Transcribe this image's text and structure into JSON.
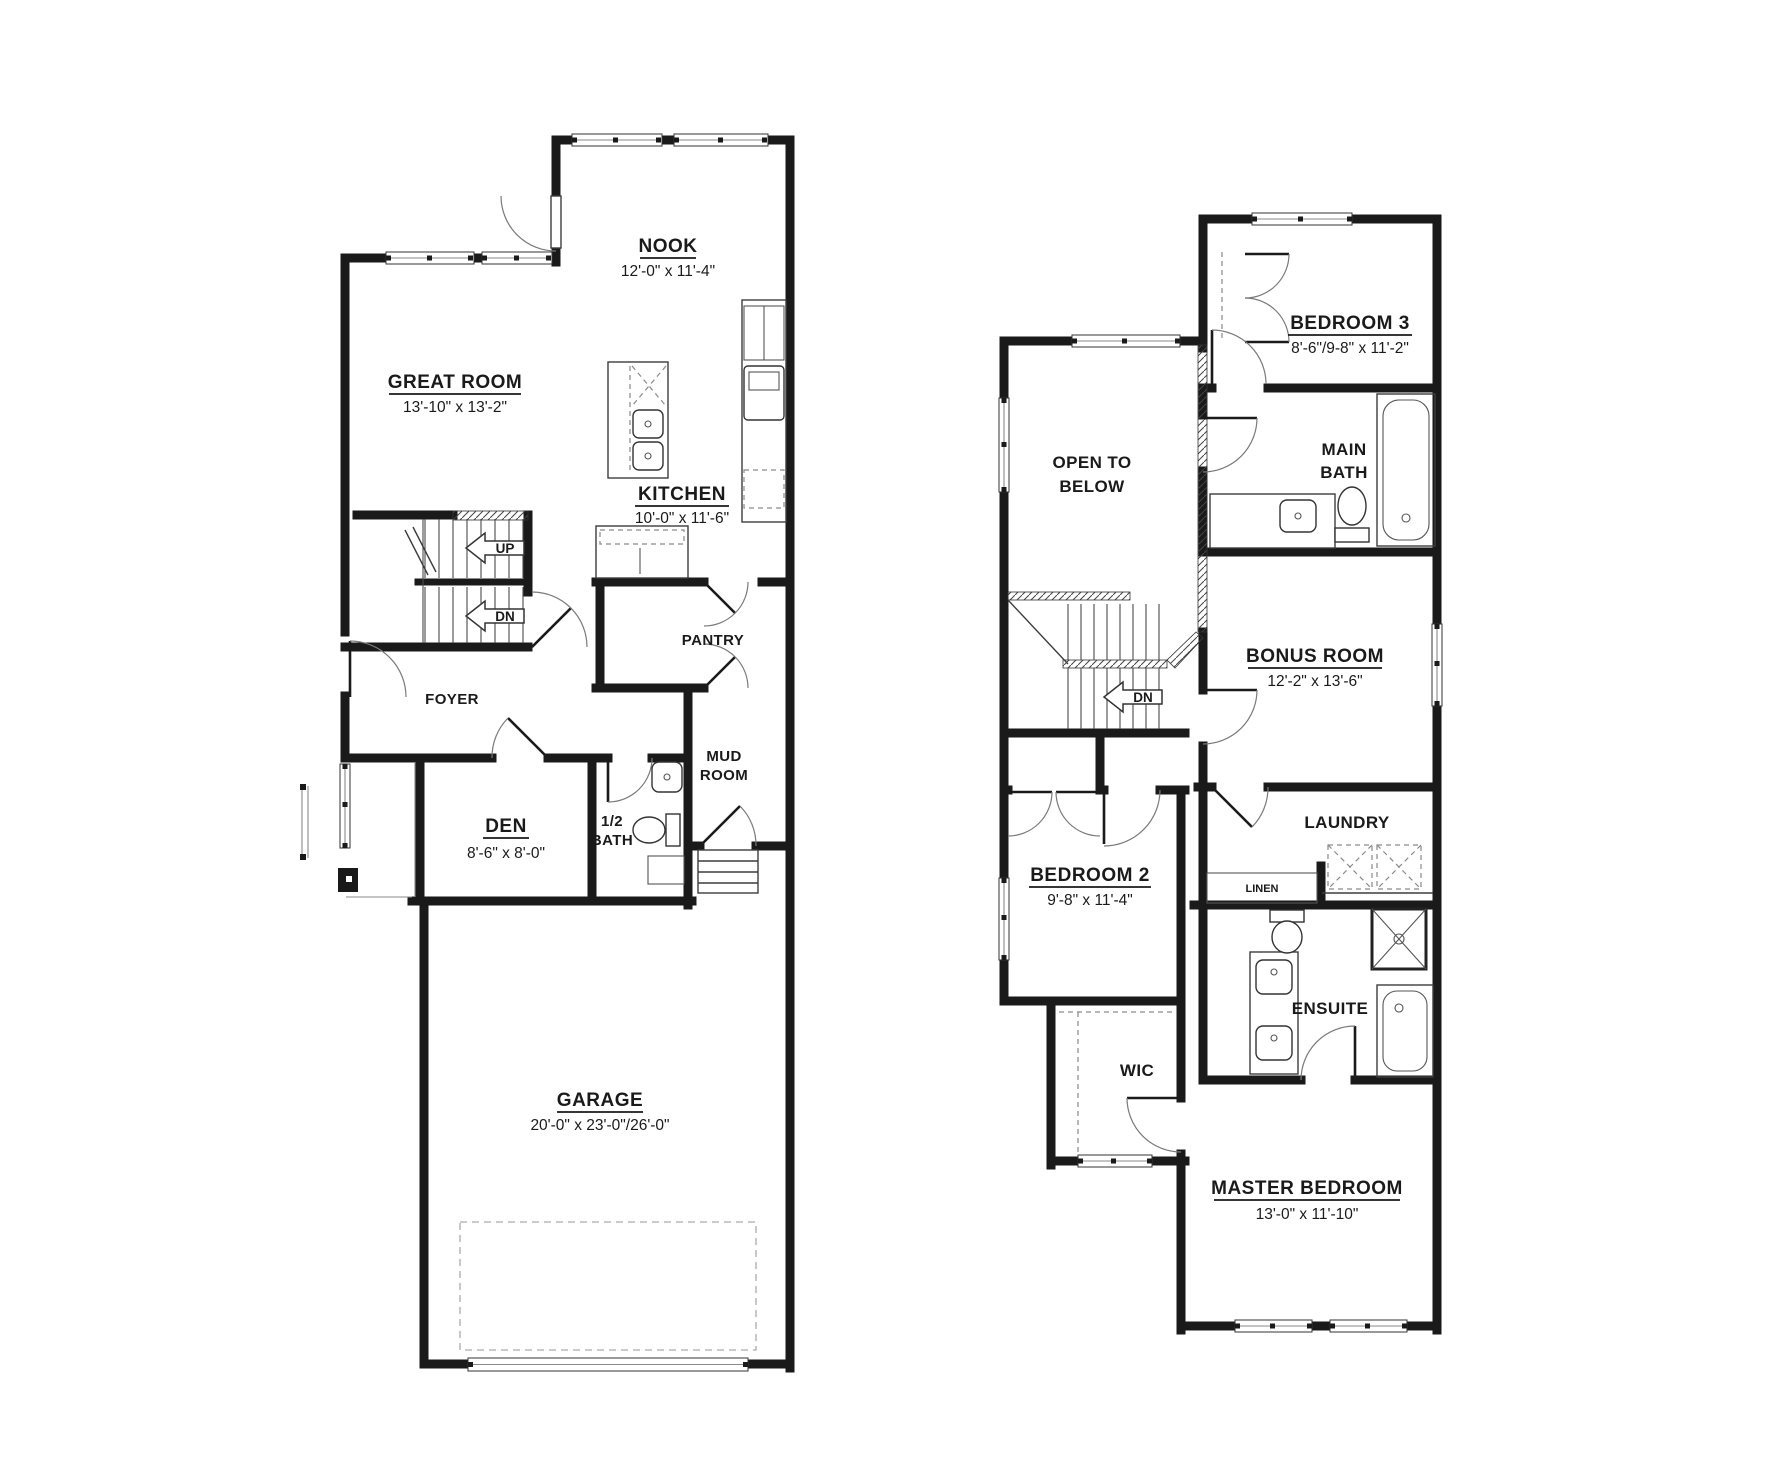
{
  "colors": {
    "background": "#ffffff",
    "wall": "#1a1a1a",
    "thin_line": "#3d3d3d",
    "door_arc": "#7a7a7a",
    "dashed": "#8a8a8a"
  },
  "main_floor": {
    "rooms": {
      "nook": {
        "name": "NOOK",
        "dims": "12'-0\" x 11'-4\""
      },
      "great_room": {
        "name": "GREAT ROOM",
        "dims": "13'-10\" x 13'-2\""
      },
      "kitchen": {
        "name": "KITCHEN",
        "dims": "10'-0\" x 11'-6\""
      },
      "pantry": {
        "name": "PANTRY"
      },
      "foyer": {
        "name": "FOYER"
      },
      "den": {
        "name": "DEN",
        "dims": "8'-6\" x 8'-0\""
      },
      "half_bath": {
        "line1": "1/2",
        "line2": "BATH"
      },
      "mud_room": {
        "line1": "MUD",
        "line2": "ROOM"
      },
      "garage": {
        "name": "GARAGE",
        "dims": "20'-0\" x 23'-0\"/26'-0\""
      }
    },
    "stairs": {
      "up": "UP",
      "down": "DN"
    }
  },
  "upper_floor": {
    "rooms": {
      "open_to_below": {
        "line1": "OPEN TO",
        "line2": "BELOW"
      },
      "bedroom3": {
        "name": "BEDROOM 3",
        "dims": "8'-6\"/9-8\" x 11'-2\""
      },
      "main_bath": {
        "line1": "MAIN",
        "line2": "BATH"
      },
      "bonus_room": {
        "name": "BONUS ROOM",
        "dims": "12'-2\" x 13'-6\""
      },
      "bedroom2": {
        "name": "BEDROOM 2",
        "dims": "9'-8\" x 11'-4\""
      },
      "laundry": {
        "name": "LAUNDRY"
      },
      "linen": {
        "name": "LINEN"
      },
      "wic": {
        "name": "WIC"
      },
      "ensuite": {
        "name": "ENSUITE"
      },
      "master_bedroom": {
        "name": "MASTER BEDROOM",
        "dims": "13'-0\" x 11'-10\""
      }
    },
    "stairs": {
      "down": "DN"
    }
  }
}
